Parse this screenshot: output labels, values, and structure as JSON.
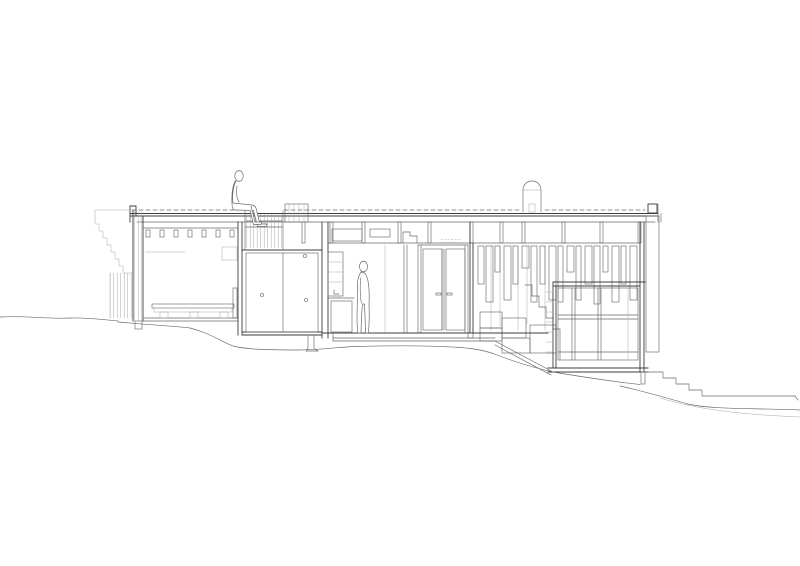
{
  "colors": {
    "paper": "#ffffff",
    "line": "#6a6a6a",
    "lineDark": "#3d3d3d",
    "lineLight": "#a8a8a8"
  },
  "drawing": {
    "kind": "architectural cross-section drawing of a single-storey house built into a hillside",
    "people": [
      "person seated on the roof deck at the light-well edge",
      "person standing in the interior beside a sink cabinet"
    ],
    "features": [
      "stepped timber stack against the left exterior wall",
      "flat roof deck with dashed board line and joist posts",
      "recessed roof light-well",
      "cylindrical roof vent with domed cap",
      "low slatted bench in left room",
      "large double storage panels with knobs",
      "tall double glazed doors",
      "hanging slatted screen battens",
      "interior stair stepping down to lower room",
      "lower room with transom window wall",
      "slatted cladding band at right edge",
      "exterior stairs cut into the slope",
      "continuous terrain line across the sheet"
    ]
  }
}
